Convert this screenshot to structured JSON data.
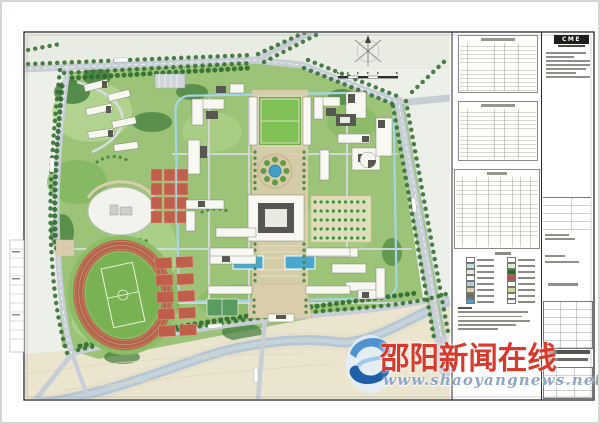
{
  "titleblock": {
    "logo_text": "CME"
  },
  "watermark": {
    "site_name": "邵阳新闻在线",
    "site_url": "www.shaoyangnews.net",
    "name_color": "#d8392b",
    "url_color": "#8ea7c7"
  },
  "panel": {
    "tables": [
      {
        "name": "indicator-table-1",
        "rows": 13,
        "cols": 5
      },
      {
        "name": "indicator-table-2",
        "rows": 13,
        "cols": 5
      },
      {
        "name": "indicator-table-3",
        "rows": 15,
        "cols": 8
      }
    ],
    "legend": {
      "rows": 8,
      "cols": 2,
      "swatches": [
        "#ffffff",
        "#ffffff",
        "#bfe0f2",
        "#dcebc8",
        "#e8e8e4",
        "#2f6b31",
        "#ffffff",
        "#b8544a",
        "#a9cce8",
        "#ffffff",
        "#d9cdae",
        "#c8dc9c",
        "#6f6f69",
        "#ffffff",
        "#4f9fd0",
        "#ffffff"
      ]
    },
    "notes_line_count": 6
  },
  "map": {
    "colors": {
      "lawn": "#9cc377",
      "tree": "#3a7336",
      "road": "#c7ced5",
      "river": "#b6c7d3",
      "track": "#b4664d",
      "court_red": "#bf5f4b",
      "pond_blue": "#3f9fc4",
      "pool_blue": "#49a8cd",
      "plaza_tan": "#d9cdab",
      "building_white": "#f8f8f3",
      "building_dark": "#57564f",
      "bank_cream": "#ebe5d0"
    }
  }
}
